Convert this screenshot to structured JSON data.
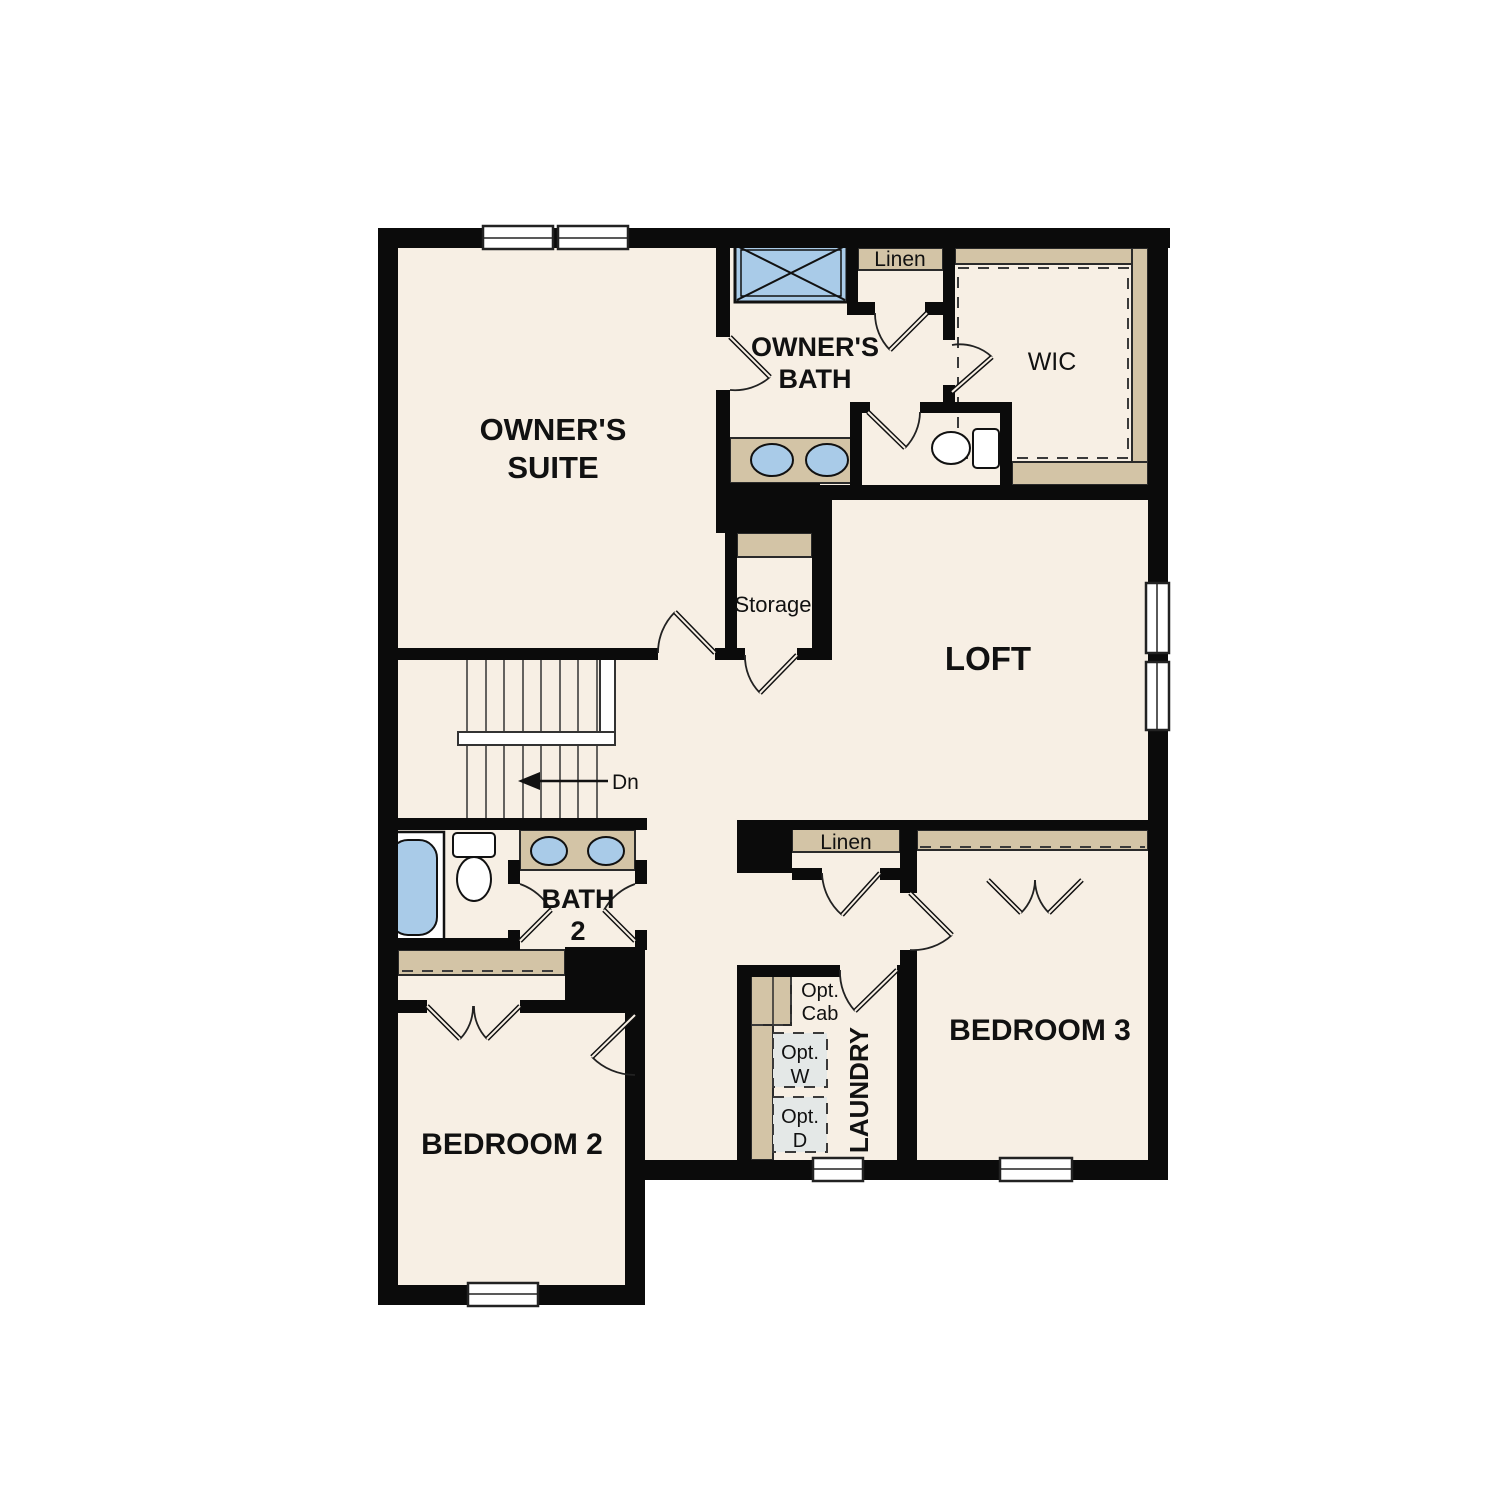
{
  "plan": {
    "type": "residential-second-floor-plan",
    "rooms": [
      "Owner's Suite",
      "Owner's Bath",
      "WIC",
      "Loft",
      "Storage",
      "Bath 2",
      "Bedroom 2",
      "Bedroom 3",
      "Laundry",
      "Linen",
      "Linen"
    ],
    "fixtures": [
      "shower",
      "double-vanity-sinks",
      "toilet",
      "walk-in-closet-shelving",
      "bathtub",
      "washer-optional",
      "dryer-optional",
      "stairs-down"
    ]
  },
  "colors": {
    "floor": "#f7efe4",
    "wall": "#0b0b0b",
    "casework_tan": "#d3c4a6",
    "fixture_blue": "#a9cbe8",
    "optional_gray": "#e4e8e7",
    "page": "#ffffff"
  },
  "labels": {
    "owners_suite_1": "OWNER'S",
    "owners_suite_2": "SUITE",
    "owners_bath_1": "OWNER'S",
    "owners_bath_2": "BATH",
    "wic": "WIC",
    "linen_top": "Linen",
    "linen_hall": "Linen",
    "storage": "Storage",
    "loft": "LOFT",
    "stairs_dn": "Dn",
    "bath2_1": "BATH",
    "bath2_2": "2",
    "bedroom3": "BEDROOM 3",
    "bedroom2": "BEDROOM 2",
    "laundry": "LAUNDRY",
    "opt_cab_1": "Opt.",
    "opt_cab_2": "Cab",
    "opt_w_1": "Opt.",
    "opt_w_2": "W",
    "opt_d_1": "Opt.",
    "opt_d_2": "D"
  }
}
